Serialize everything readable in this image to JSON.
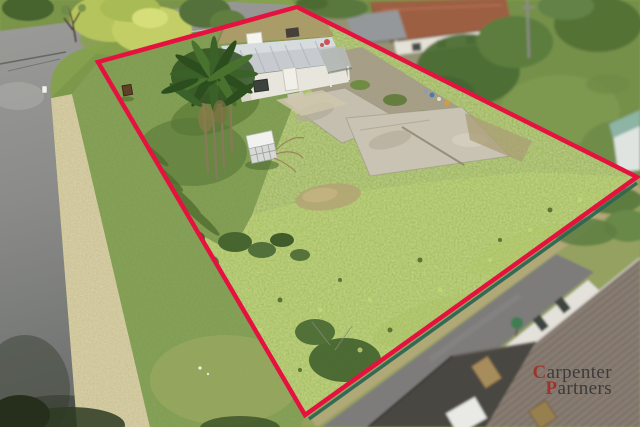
{
  "watermark": {
    "line1_initial": "C",
    "line1_rest": "arpenter",
    "line2_initial": "P",
    "line2_rest": "artners",
    "initial_color": "#9e2f28",
    "text_color": "#2c2c30"
  },
  "annotation": {
    "boundary_points": "98,62 297,7 637,177 305,415",
    "boundary_color": "#e51240"
  },
  "photo": {
    "colors": {
      "lawn_overgrown": "#9cb852",
      "lawn_mowed": "#7c9949",
      "road": "#8f9091",
      "dry_grass_verge": "#c6bc8d",
      "fence_white": "#c9cdd0",
      "fence_teal": "#2f6653",
      "subject_roof_tan": "#aa9c68",
      "subject_roof_metal": "#c7cbcf",
      "neighbor_roof_terracotta": "#9d5e43",
      "neighbor_roof_tiled": "#8c8076",
      "concrete_slab": "#c8c3b2"
    }
  }
}
